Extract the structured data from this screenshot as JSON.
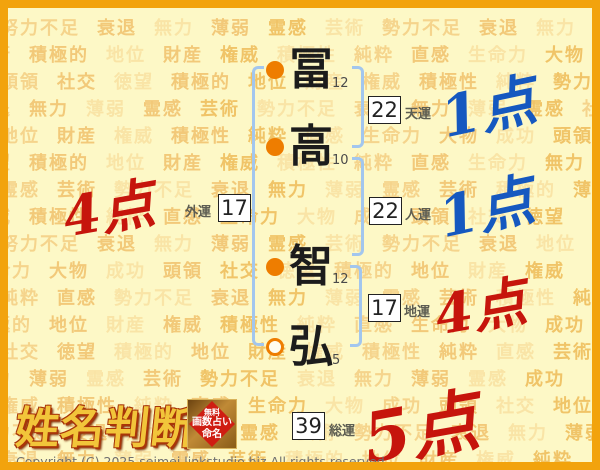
{
  "colors": {
    "border_orange": "#f2a30d",
    "background": "#fdf8c6",
    "bullet_orange": "#ee7d00",
    "bracket_blue": "#a2c6ee",
    "score_blue": "#1558c0",
    "score_red": "#c6150c",
    "logo_gold": "#f2c53a"
  },
  "chart": {
    "characters": [
      {
        "char": "冨",
        "strokes": "12",
        "bullet": "filled"
      },
      {
        "char": "高",
        "strokes": "10",
        "bullet": "filled"
      },
      {
        "char": "智",
        "strokes": "12",
        "bullet": "filled"
      },
      {
        "char": "弘",
        "strokes": "5",
        "bullet": "open"
      }
    ],
    "fortunes": [
      {
        "name": "天運",
        "value": "22",
        "score": "1点",
        "score_color": "blue"
      },
      {
        "name": "人運",
        "value": "22",
        "score": "1点",
        "score_color": "blue"
      },
      {
        "name": "地運",
        "value": "17",
        "score": "4点",
        "score_color": "red"
      },
      {
        "name": "外運",
        "value": "17",
        "score": "4点",
        "score_color": "red"
      },
      {
        "name": "総運",
        "value": "39",
        "score": "5点",
        "score_color": "red"
      }
    ]
  },
  "logo": {
    "title": "姓名判断",
    "badge_line1": "無料",
    "badge_line2": "画数占い",
    "badge_line3": "命名"
  },
  "footer": {
    "copyright": "Copyright (C) 2025 seimei.linkstudio.biz All rights reserved."
  },
  "watermark": {
    "rows": [
      "努力不足 衰退 無力 薄弱 霊感 芸術 勢力不足 衰退 無力 薄弱",
      "芸術 積極的 地位 財産 権威 積極性 純粋 直感 生命力 大物 成功",
      "頭領 社交 徳望 積極的 地位 財産 権威 積極性 純粋 勢力不足",
      "衰退 無力 薄弱 霊感 芸術 勢力不足 衰退 無力 薄弱 霊感 社交",
      "地位 財産 権威 積極性 純粋 直感 生命力 大物 成功 頭領 地位",
      "徳望 積極的 地位 財産 権威 積極性 純粋 直感 生命力 無力 衰退",
      "霊感 芸術 勢力不足 衰退 無力 薄弱 霊感 芸術 積極的 薄弱",
      "権威 積極性 純粋 直感 生命力 大物 成功 頭領 社交 徳望",
      "努力不足 衰退 無力 薄弱 霊感 芸術 勢力不足 衰退 地位 財産",
      "生命力 大物 成功 頭領 社交 徳望 積極的 地位 財産 権威",
      "純粋 直感 勢力不足 衰退 無力 薄弱 霊感 芸術 積極性 純粋",
      "積極的 地位 財産 権威 積極性 純粋 直感 生命力 大物 成功",
      "社交 徳望 積極的 地位 財産 権威 積極性 純粋 直感 芸術",
      "無力 薄弱 霊感 芸術 勢力不足 衰退 無力 薄弱 霊感 成功",
      "権威 積極性 純粋 直感 生命力 大物 成功 頭領 社交 地位",
      "努力不足 衰退 無力 薄弱 霊感 芸術 勢力不足 衰退 無力 薄弱",
      "衰退 無力 薄弱 霊感 芸術 積極的 地位 財産 権威 純粋"
    ]
  }
}
